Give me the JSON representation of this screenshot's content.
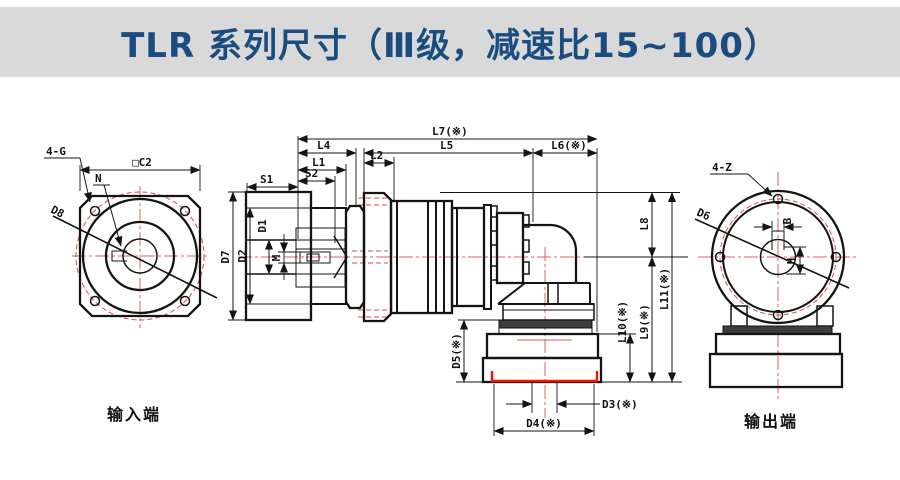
{
  "title": "TLR 系列尺寸（Ⅲ级，减速比15~100）",
  "captions": {
    "input": "输入端",
    "output": "输出端"
  },
  "input_view": {
    "holes": "4-G",
    "keyway": "N",
    "diagonal_diameter": "D8",
    "square_size": "□C2"
  },
  "side_view": {
    "s1": "S1",
    "s2": "S2",
    "l1": "L1",
    "l2": "L2",
    "l4": "L4",
    "l5": "L5",
    "l6": "L6(※)",
    "l7": "L7(※)",
    "d1": "D1",
    "d2": "D2",
    "d7": "D7",
    "m": "M",
    "l8": "L8",
    "l9": "L9(※)",
    "l10": "L10(※)",
    "l11": "L11(※)",
    "d3": "D3(※)",
    "d4": "D4(※)",
    "d5": "D5(※)"
  },
  "output_view": {
    "holes": "4-Z",
    "diagonal_diameter": "D6",
    "key_width": "B",
    "key_depth": "H"
  },
  "colors": {
    "title_text": "#1a4c80",
    "banner": "#d9d9d9",
    "drawing_line": "#141414",
    "centerline_red": "#e06262",
    "hidden_red": "#d84b4b",
    "highlight_red": "#ee1606"
  }
}
